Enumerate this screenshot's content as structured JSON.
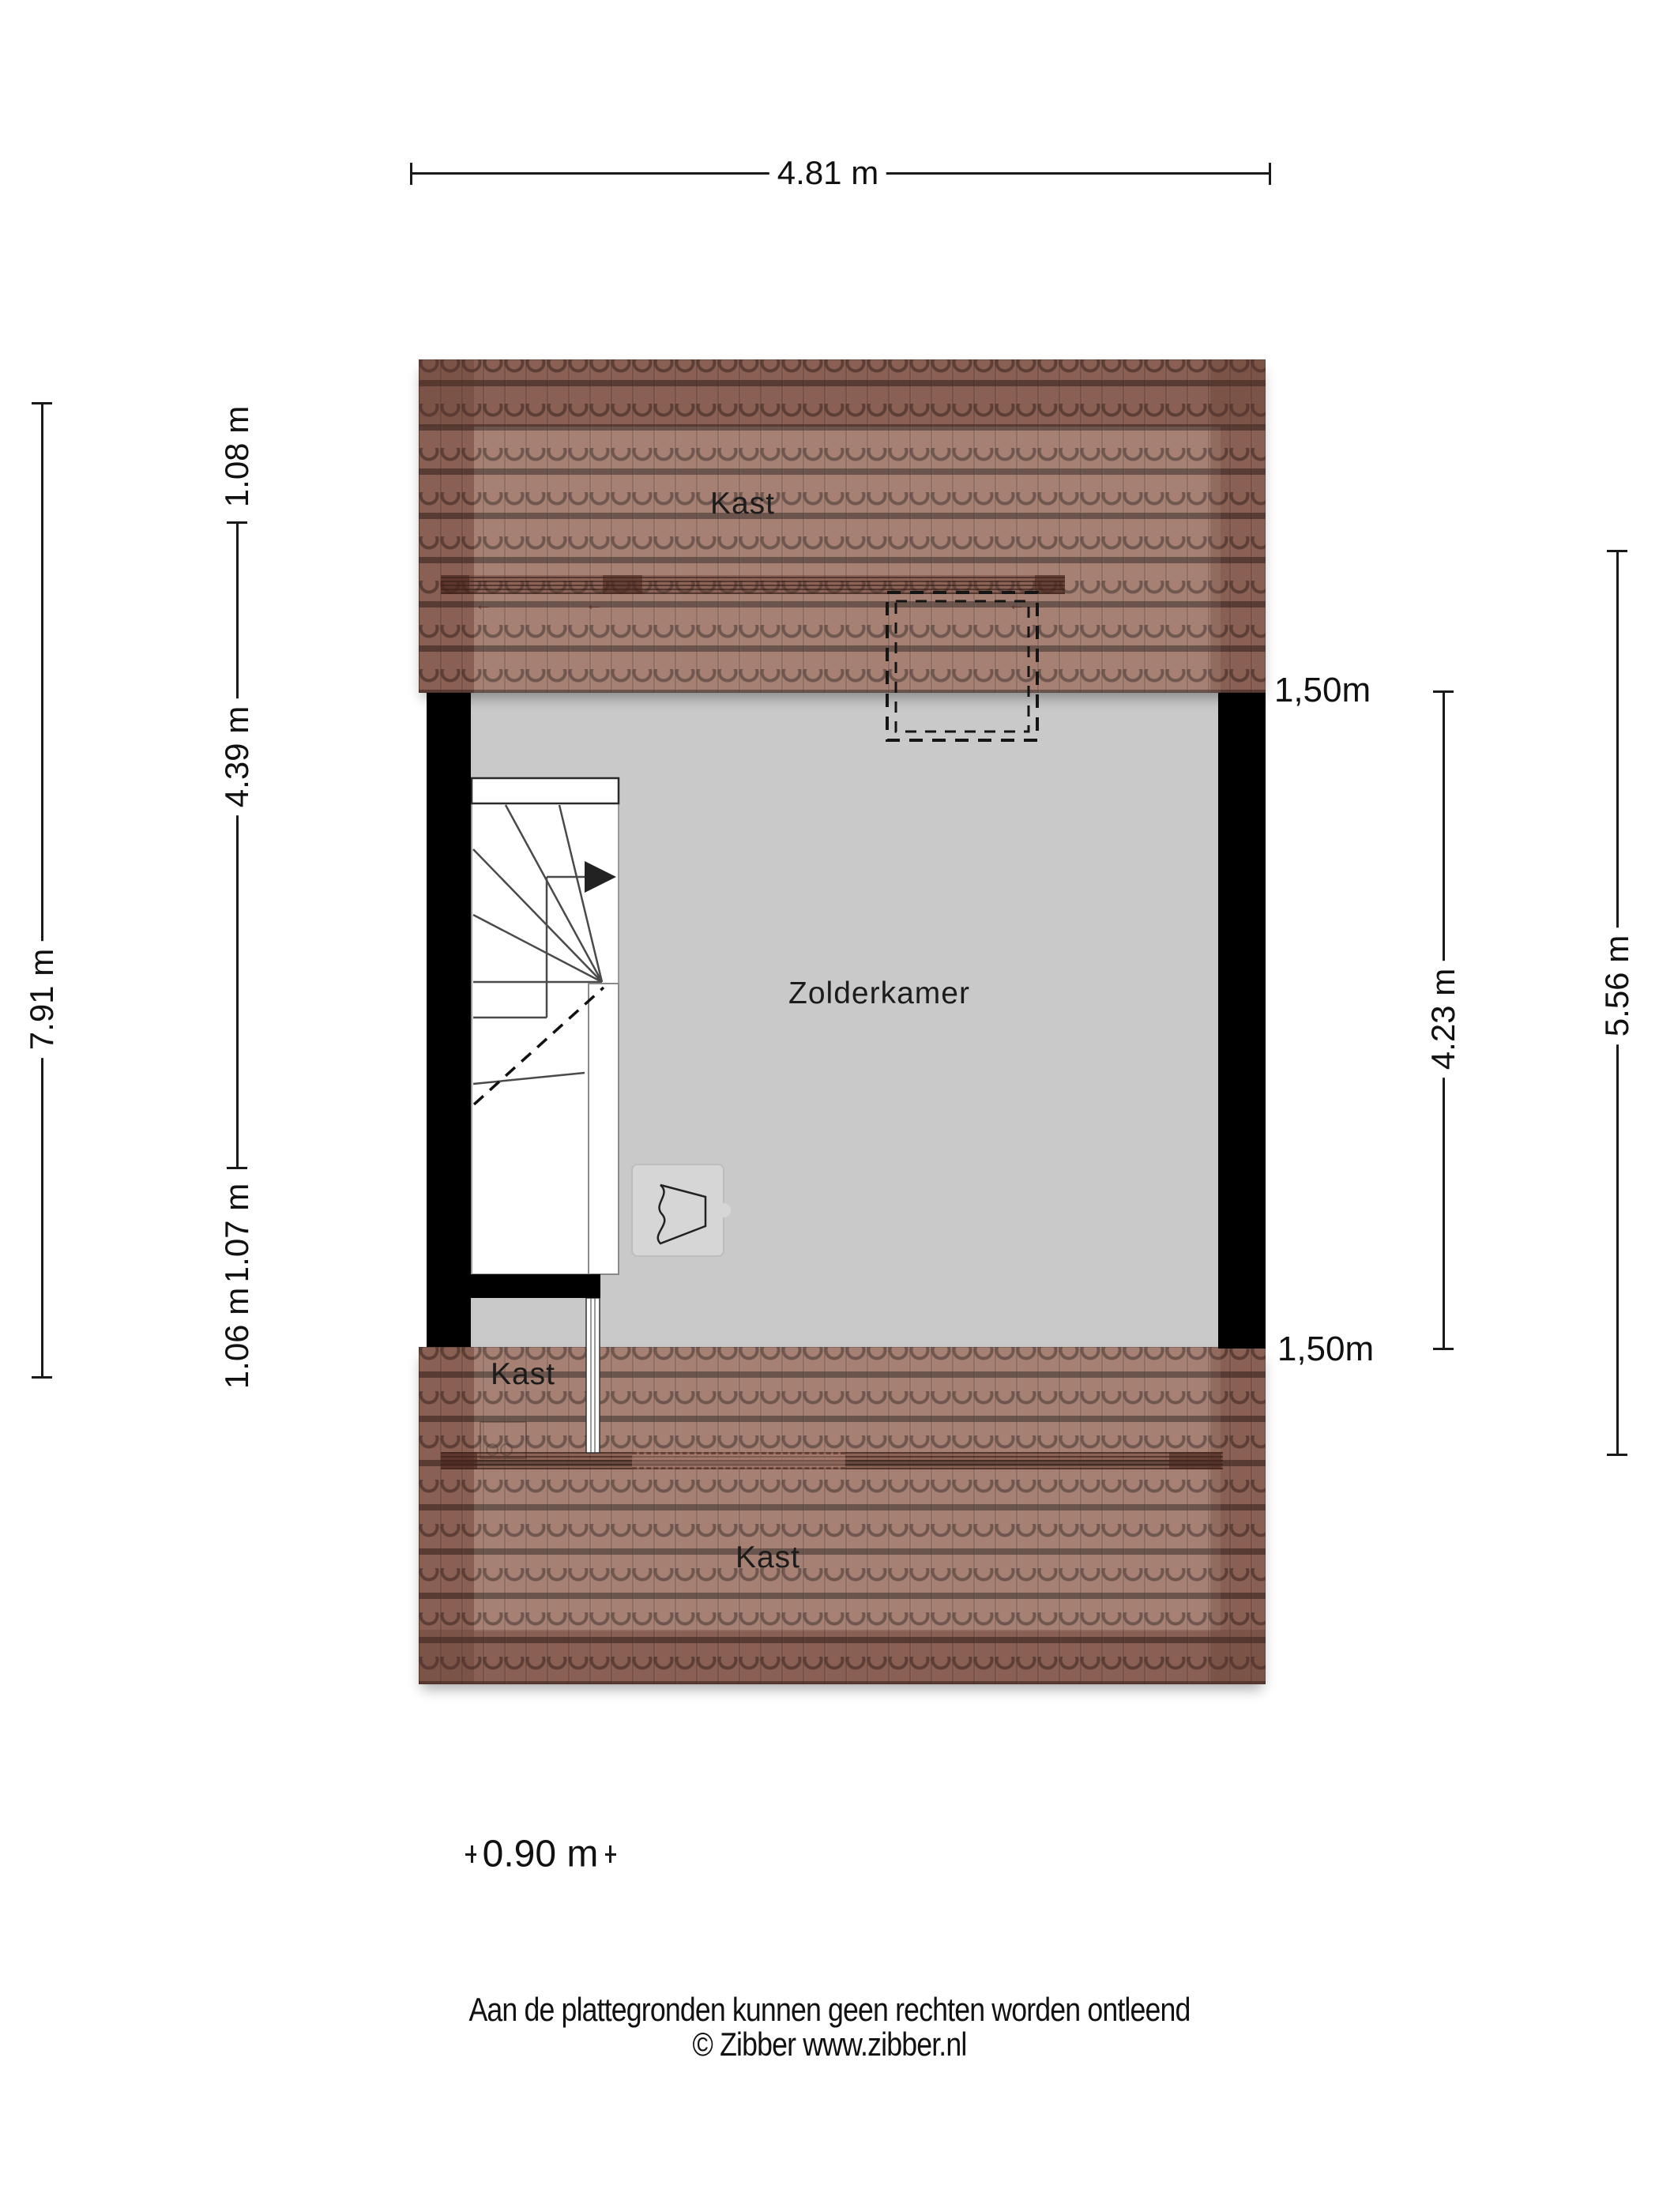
{
  "plan": {
    "rooms": {
      "kast_top": "Kast",
      "zolderkamer": "Zolderkamer",
      "kast_left": "Kast",
      "kast_bottom": "Kast"
    },
    "icons": {
      "roof_opening_arrow": "←"
    }
  },
  "dimensions": {
    "top_width": "4.81 m",
    "left_total": "7.91 m",
    "left_segments": [
      {
        "label": "1.08 m"
      },
      {
        "label": "4.39 m"
      },
      {
        "label": "1.07 m"
      },
      {
        "label": "1.06 m"
      }
    ],
    "knee_wall_top": "1,50m",
    "knee_wall_bottom": "1,50m",
    "right_room_height": "4.23 m",
    "right_total": "5.56 m",
    "stair_width": "0.90 m"
  },
  "footer": {
    "disclaimer": "Aan de plattegronden kunnen geen rechten worden ontleend",
    "credit": "© Zibber www.zibber.nl"
  },
  "colors": {
    "roof_tile": "#9c7263",
    "floor": "#c9c9c9",
    "wall": "#000000",
    "dimension_text": "#111111",
    "background": "#ffffff"
  }
}
